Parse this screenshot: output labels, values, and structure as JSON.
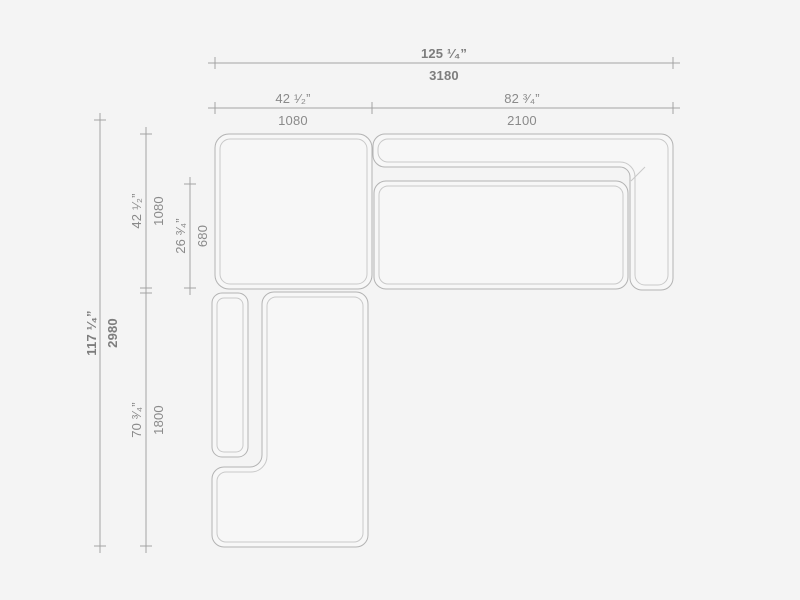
{
  "drawing_title": "Sectional sofa plan view with dimensions",
  "colors": {
    "background": "#f4f4f4",
    "module_fill": "#f7f7f7",
    "module_outline": "#b3b3b3",
    "inner_line": "#c9c9c9",
    "dimension_line": "#a3a3a3",
    "label_text": "#8a8a8a"
  },
  "dimensions": {
    "overall_width": {
      "inches": "125 ¹⁄₄”",
      "mm": "3180"
    },
    "corner_width": {
      "inches": "42 ¹⁄₂”",
      "mm": "1080"
    },
    "sofa_width": {
      "inches": "82 ³⁄₄”",
      "mm": "2100"
    },
    "overall_depth": {
      "inches": "117 ¹⁄₄”",
      "mm": "2980"
    },
    "corner_depth": {
      "inches": "42 ¹⁄₂”",
      "mm": "1080"
    },
    "seat_depth": {
      "inches": "26 ³⁄₄”",
      "mm": "680"
    },
    "chaise_length": {
      "inches": "70 ³⁄₄”",
      "mm": "1800"
    }
  }
}
